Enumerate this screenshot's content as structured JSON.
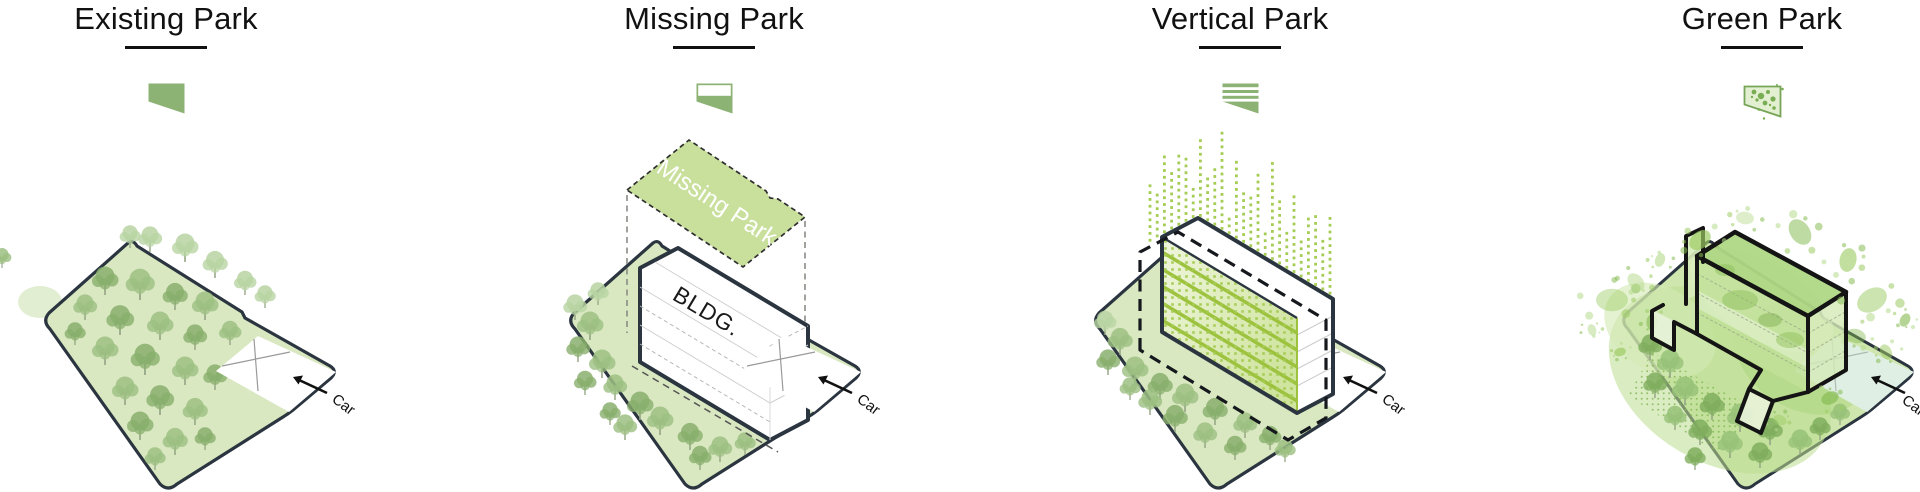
{
  "panels": [
    {
      "title": "Existing Park",
      "icon": "existing-park-icon",
      "diagram": {
        "car_label": "Car"
      }
    },
    {
      "title": "Missing Park",
      "icon": "missing-park-icon",
      "diagram": {
        "car_label": "Car",
        "building_label": "BLDG.",
        "plane_label": "Missing Park"
      }
    },
    {
      "title": "Vertical Park",
      "icon": "vertical-park-icon",
      "diagram": {
        "car_label": "Car"
      }
    },
    {
      "title": "Green Park",
      "icon": "green-park-icon",
      "diagram": {
        "car_label": "Car"
      }
    }
  ],
  "colors": {
    "icon_green": "#8cb274",
    "site_fill": "#d9e8c1",
    "site_outline": "#2b3540",
    "tree_greens": [
      "#9cbf82",
      "#b8d4a3",
      "#88af6d",
      "#7fae5e",
      "#97c278"
    ],
    "stripe_green": "#9cc23e",
    "dot_green": "#a5cc54",
    "plane_fill": "#c9e09c",
    "ink": "#1c1c1c"
  }
}
